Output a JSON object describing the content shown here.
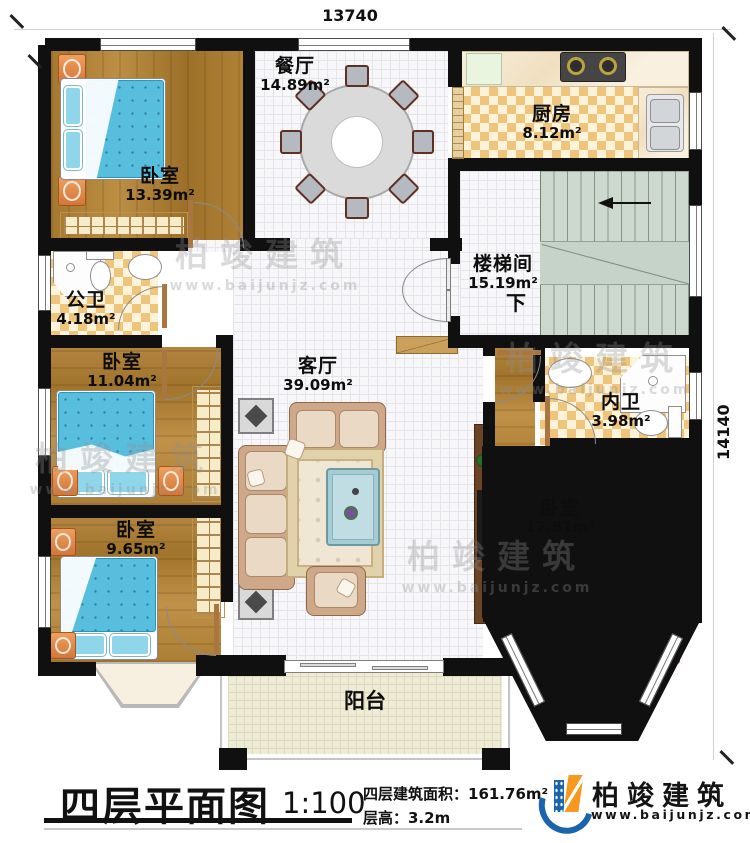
{
  "plan": {
    "dim_width": "13740",
    "dim_height": "14140",
    "rooms": {
      "bedroom_top_left": {
        "name": "卧室",
        "area": "13.39m²"
      },
      "dining": {
        "name": "餐厅",
        "area": "14.89m²"
      },
      "kitchen": {
        "name": "厨房",
        "area": "8.12m²"
      },
      "stairwell": {
        "name": "楼梯间",
        "area": "15.19m²",
        "direction": "下"
      },
      "public_bathroom": {
        "name": "公卫",
        "area": "4.18m²"
      },
      "bedroom_mid_left": {
        "name": "卧室",
        "area": "11.04m²"
      },
      "living": {
        "name": "客厅",
        "area": "39.09m²"
      },
      "ensuite_bathroom": {
        "name": "内卫",
        "area": "3.98m²"
      },
      "bedroom_bottom_right": {
        "name": "卧室",
        "area": "17.81m²"
      },
      "bedroom_bottom_left": {
        "name": "卧室",
        "area": "9.65m²"
      },
      "balcony": {
        "name": "阳台"
      }
    }
  },
  "title_block": {
    "title": "四层平面图",
    "scale": "1:100",
    "area_line": "四层建筑面积：161.76m²",
    "height_line": "层高：3.2m"
  },
  "brand": {
    "name": "柏竣建筑",
    "website": "www.baijunjz.com"
  },
  "colors": {
    "wall": "#101010",
    "wood_floor": "#a87c36",
    "bed_blue": "#58bedd",
    "checker_tan": "#efc57b",
    "stair_green": "#cdd9cf",
    "brand_blue": "#1a63ad",
    "brand_orange": "#f6991e"
  }
}
